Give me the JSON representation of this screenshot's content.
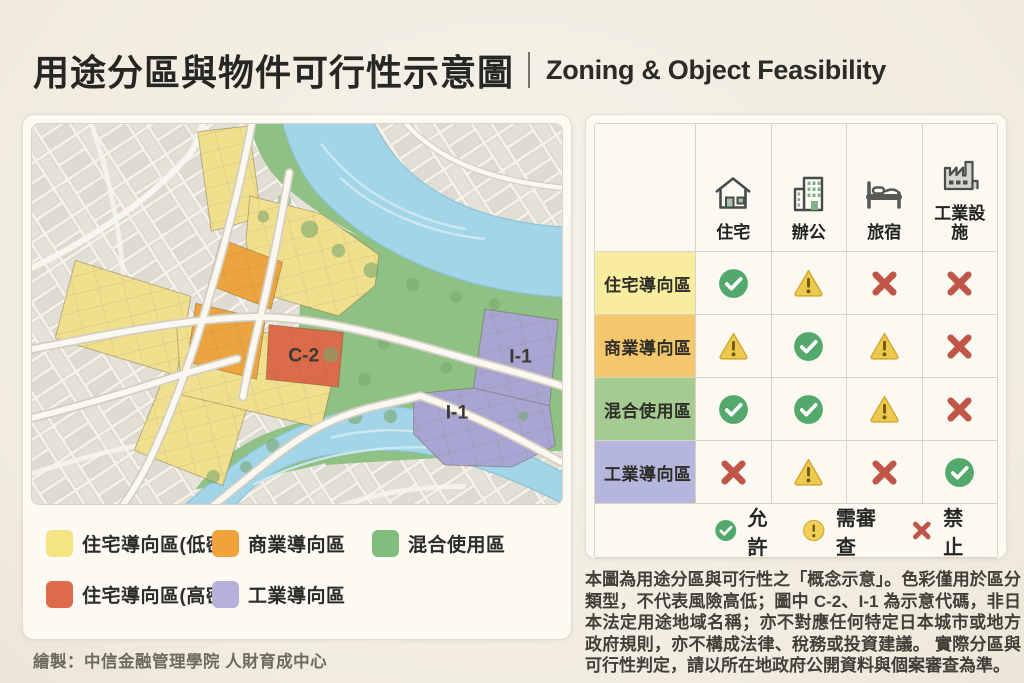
{
  "header": {
    "title_zh": "用途分區與物件可行性示意圖",
    "title_en": "Zoning & Object Feasibility"
  },
  "map_panel": {
    "zone_labels": [
      {
        "text": "C-2"
      },
      {
        "text": "I-1"
      },
      {
        "text": "I-1"
      }
    ],
    "legend": [
      {
        "label": "住宅導向區(低密)",
        "color": "#f5e482"
      },
      {
        "label": "商業導向區",
        "color": "#f0a33c"
      },
      {
        "label": "混合使用區",
        "color": "#83bd7e"
      },
      {
        "label": "住宅導向區(高密)",
        "color": "#dd6a4a"
      },
      {
        "label": "工業導向區",
        "color": "#b5b0dc"
      }
    ]
  },
  "matrix": {
    "columns": [
      {
        "label": "住宅",
        "icon": "house-icon"
      },
      {
        "label": "辦公",
        "icon": "office-icon"
      },
      {
        "label": "旅宿",
        "icon": "bed-icon"
      },
      {
        "label": "工業設施",
        "icon": "factory-icon"
      }
    ],
    "rows": [
      {
        "label": "住宅導向區",
        "color": "#f8ec9e",
        "cells": [
          "allow",
          "review",
          "deny",
          "deny"
        ]
      },
      {
        "label": "商業導向區",
        "color": "#f4c76d",
        "cells": [
          "review",
          "allow",
          "review",
          "deny"
        ]
      },
      {
        "label": "混合使用區",
        "color": "#a5cb93",
        "cells": [
          "allow",
          "allow",
          "review",
          "deny"
        ]
      },
      {
        "label": "工業導向區",
        "color": "#b4b6dd",
        "cells": [
          "deny",
          "review",
          "deny",
          "allow"
        ]
      }
    ],
    "legend": [
      {
        "symbol": "allow",
        "label": "允許"
      },
      {
        "symbol": "review-circle",
        "label": "需審查"
      },
      {
        "symbol": "deny",
        "label": "禁止"
      }
    ]
  },
  "map_colors": {
    "residential_low": "#f0e08e",
    "residential_high": "#dc6b4b",
    "commercial": "#eca440",
    "mixed": "#8fc084",
    "industrial": "#a9a5d2",
    "river": "#a3d5e8"
  },
  "disclaimer": "本圖為用途分區與可行性之「概念示意」。色彩僅用於區分類型，不代表風險高低；圖中 C-2、I-1 為示意代碼，非日本法定用途地域名稱；亦不對應任何特定日本城市或地方政府規則，亦不構成法律、稅務或投資建議。 實際分區與可行性判定，請以所在地政府公開資料與個案審查為準。",
  "footer": "繪製：中信金融管理學院 人財育成中心"
}
